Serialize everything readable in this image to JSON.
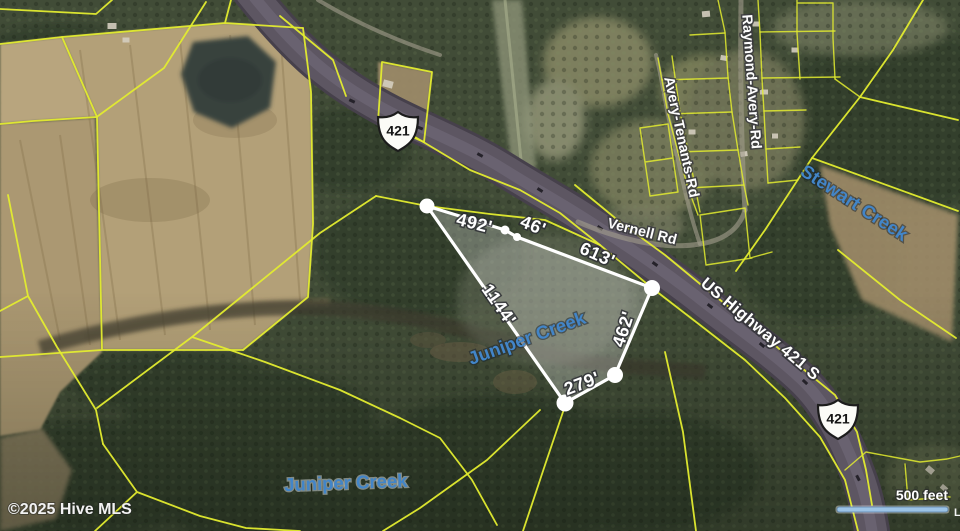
{
  "map": {
    "attribution": "©2025 Hive MLS",
    "scale_bar": {
      "label": "500 feet"
    },
    "edge_fragment": "L",
    "highway_shield_number": "421",
    "road_labels": {
      "us_highway": "US Highway 421 S",
      "vernell": "Vernell Rd",
      "raymond_avery": "Raymond-Avery-Rd",
      "avery_tenants": "Avery-Tenants-Rd"
    },
    "water_labels": {
      "juniper_creek_on_parcel": "Juniper Creek",
      "juniper_creek_south": "Juniper Creek",
      "stewart_creek": "Stewart Creek"
    },
    "parcel_outline": {
      "side_lengths": {
        "north_a": "492'",
        "north_b": "46'",
        "northeast": "613'",
        "west": "1144'",
        "east": "462'",
        "south": "279'"
      }
    },
    "theme": {
      "parcel_line_yellow": "#e3ec2f",
      "outline_white": "#ffffff",
      "creek_label_blue": "#4285c8",
      "scale_bar_blue": "#9cc3e5",
      "highway_asphalt": "#5d5662",
      "field_tan": "#b3a078",
      "forest_green": "#414c37"
    }
  }
}
